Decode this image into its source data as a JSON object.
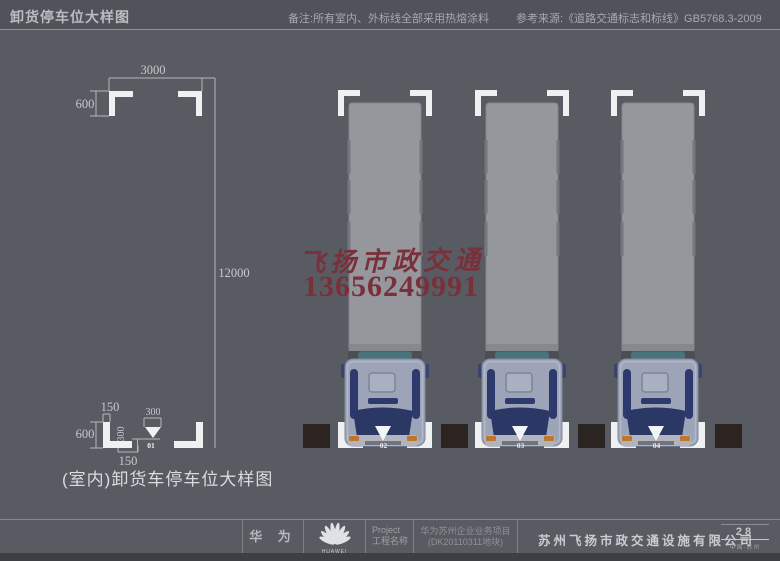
{
  "header": {
    "title": "卸货停车位大样图",
    "note": "备注:所有室内、外标线全部采用热熔涂料",
    "reference": "参考来源:《道路交通标志和标线》GB5768.3-2009"
  },
  "detail_drawing": {
    "caption": "(室内)卸货车停车位大样图",
    "entrance_label": "01",
    "dims": {
      "width": "3000",
      "corner_depth": "600",
      "length": "12000",
      "stripe_width_top": "150",
      "arrow_width": "300",
      "arrow_height": "300",
      "corner_depth_bottom": "600",
      "stripe_width_bottom": "150"
    }
  },
  "watermark": {
    "name": "飞扬市政交通",
    "phone": "13656249991",
    "color": "#7a2f3a"
  },
  "parking_spaces": [
    {
      "label": "02"
    },
    {
      "label": "03"
    },
    {
      "label": "04"
    }
  ],
  "footer": {
    "brand": "华 为",
    "logo_caption": "HUAWEI",
    "project_label_en": "Project",
    "project_label_zh": "工程名称",
    "project_name_line1": "华为苏州企业业务项目",
    "project_name_line2": "(DK20110311地块)",
    "company": "苏州飞扬市政交通设施有限公司",
    "page_number": "28",
    "location": "中国·苏州"
  }
}
